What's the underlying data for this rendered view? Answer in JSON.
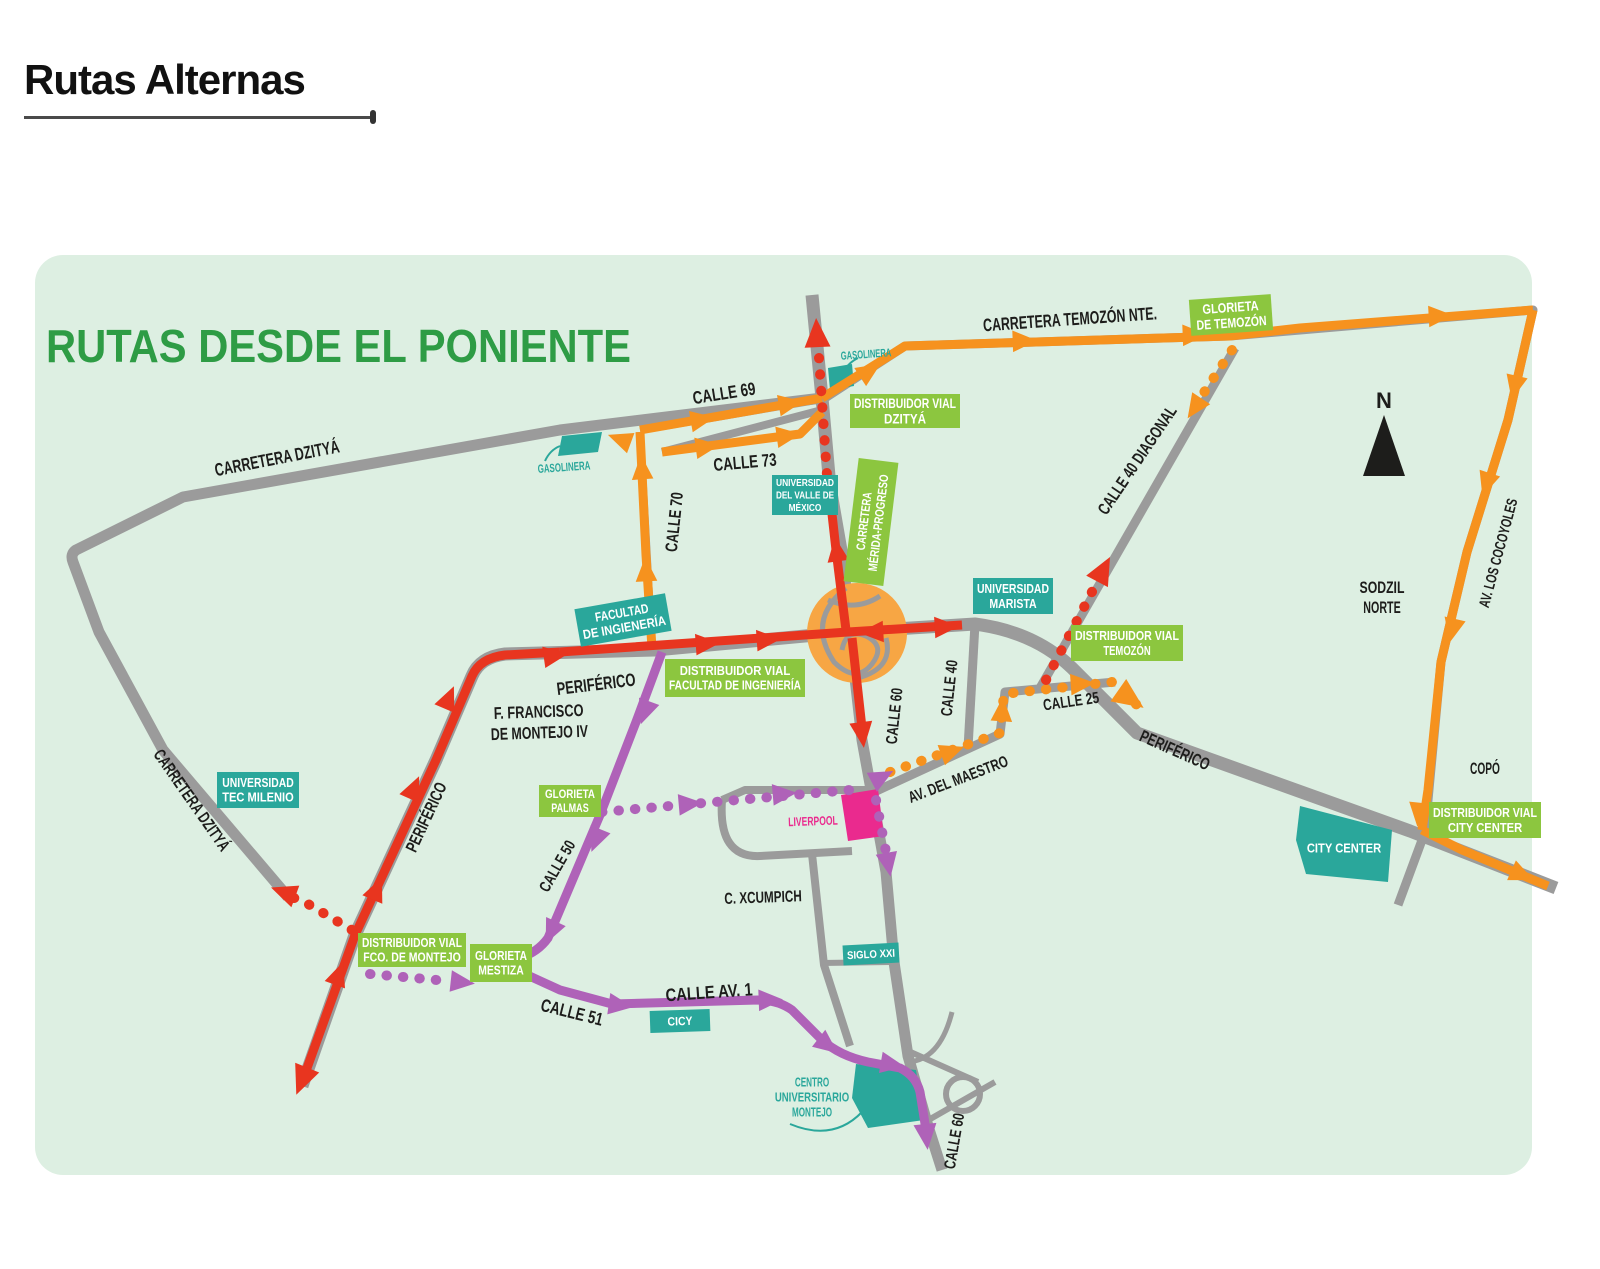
{
  "page": {
    "title": "Rutas Alternas"
  },
  "map": {
    "title": "RUTAS DESDE EL PONIENTE",
    "compass_letter": "N",
    "colors": {
      "map_bg": "#ddefe2",
      "road_gray": "#9b9b9b",
      "route_orange": "#f6921e",
      "route_red": "#e8351f",
      "route_purple": "#af62b8",
      "badge_green": "#8cc63f",
      "badge_teal": "#2aa79b",
      "pink": "#ea2a8e",
      "title_green": "#2e9c45",
      "label_black": "#1d1d1b",
      "roundabout_orange": "#f7a644",
      "white": "#ffffff"
    },
    "labels": {
      "carretera_dzitya_top": "CARRETERA DZITYÁ",
      "carretera_dzitya_left": "CARRETERA DZITYÁ",
      "calle_69": "CALLE 69",
      "calle_73": "CALLE 73",
      "calle_70": "CALLE 70",
      "carretera_temozon": "CARRETERA TEMOZÓN NTE.",
      "calle_40_diagonal": "CALLE 40 DIAGONAL",
      "sodzil_norte": [
        "SODZIL",
        "NORTE"
      ],
      "av_los_cocoyoles": "AV. LOS COCOYOLES",
      "periferico_west": "PERIFÉRICO",
      "periferico_sw": "PERIFÉRICO",
      "periferico_east": "PERIFÉRICO",
      "f_francisco_montejo": [
        "F. FRANCISCO",
        "DE MONTEJO IV"
      ],
      "calle_60_mid": "CALLE 60",
      "calle_40": "CALLE 40",
      "calle_25": "CALLE 25",
      "av_del_maestro": "AV. DEL MAESTRO",
      "c_xcumpich": "C. XCUMPICH",
      "calle_50": "CALLE 50",
      "calle_51": "CALLE 51",
      "calle_av_1": "CALLE AV. 1",
      "calle_60_bottom": "CALLE 60",
      "copo": "COPÓ",
      "gasolinera_left": "GASOLINERA",
      "gasolinera_right": "GASOLINERA",
      "liverpool": "LIVERPOOL",
      "centro_universitario": [
        "CENTRO",
        "UNIVERSITARIO",
        "MONTEJO"
      ]
    },
    "badges": {
      "glorieta_temozon": {
        "lines": [
          "GLORIETA",
          "DE TEMOZÓN"
        ]
      },
      "distribuidor_dzitya": {
        "lines": [
          "DISTRIBUIDOR VIAL",
          "DZITYÁ"
        ]
      },
      "carretera_merida_progreso": {
        "lines": [
          "CARRETERA",
          "MÉRIDA-PROGRESO"
        ]
      },
      "distribuidor_temozon": {
        "lines": [
          "DISTRIBUIDOR VIAL",
          "TEMOZÓN"
        ]
      },
      "distribuidor_facultad": {
        "lines": [
          "DISTRIBUIDOR VIAL",
          "FACULTAD DE INGENIERÍA"
        ]
      },
      "glorieta_palmas": {
        "lines": [
          "GLORIETA",
          "PALMAS"
        ]
      },
      "distribuidor_fco_montejo": {
        "lines": [
          "DISTRIBUIDOR VIAL",
          "FCO. DE MONTEJO"
        ]
      },
      "glorieta_mestiza": {
        "lines": [
          "GLORIETA",
          "MESTIZA"
        ]
      },
      "distribuidor_city_center": {
        "lines": [
          "DISTRIBUIDOR VIAL",
          "CITY CENTER"
        ]
      },
      "facultad_ingenieria": {
        "lines": [
          "FACULTAD",
          "DE INGIENERÍA"
        ]
      },
      "universidad_valle_mexico": {
        "lines": [
          "UNIVERSIDAD",
          "DEL VALLE DE",
          "MÉXICO"
        ]
      },
      "universidad_marista": {
        "lines": [
          "UNIVERSIDAD",
          "MARISTA"
        ]
      },
      "universidad_tec_milenio": {
        "lines": [
          "UNIVERSIDAD",
          "TEC MILENIO"
        ]
      },
      "siglo_xxi": {
        "lines": [
          "SIGLO XXI"
        ]
      },
      "cicy": {
        "lines": [
          "CICY"
        ]
      },
      "city_center": {
        "lines": [
          "CITY CENTER"
        ]
      }
    }
  }
}
